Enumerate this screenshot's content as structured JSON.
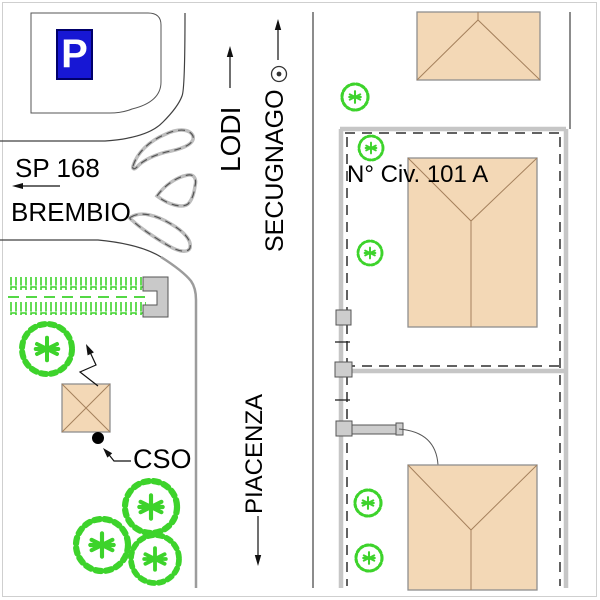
{
  "labels": {
    "parking": "P",
    "sp168": "SP 168",
    "brembio": "BREMBIO",
    "lodi": "LODI",
    "secugnago": "SECUGNAGO",
    "piacenza": "PIACENZA",
    "civic": "N° Civ. 101 A",
    "cso": "CSO"
  },
  "icons": {
    "parking_sign": "white P on blue rectangle",
    "survey_point": "double circle",
    "direction_arrow": "thin black arrow",
    "tree": "green scribbled circle with star center",
    "cso_point": "filled black dot"
  },
  "theme": {
    "parking-blue": "#1717d4",
    "building-fill": "#f3d8b6",
    "building-stroke": "#8f8f8f",
    "roof-line": "#a5815d",
    "tree-green": "#3dd32b",
    "wall-gray": "#c6c6c6",
    "dash": "#2e2e2e",
    "line": "#404040",
    "road-gray": "#9c9c9c",
    "paper": "#ffffff"
  }
}
